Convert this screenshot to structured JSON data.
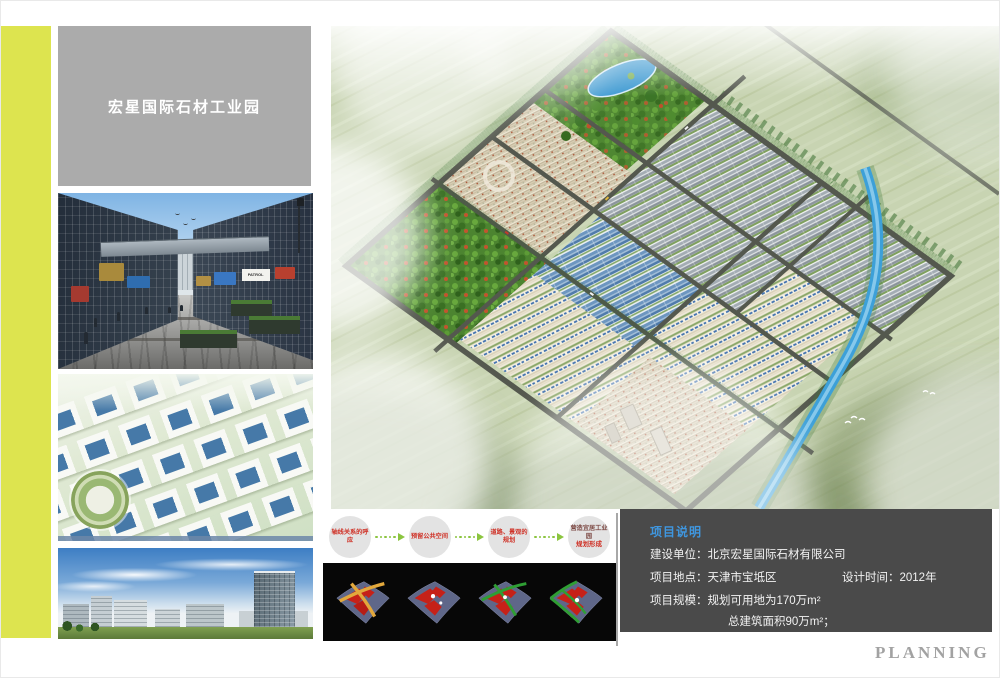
{
  "sidebar": {
    "title": "宏星国际石材工业园"
  },
  "photos": {
    "street_sign": "PATROL"
  },
  "flow_steps": [
    {
      "line1": "轴线关系的呼应",
      "line2": ""
    },
    {
      "line1": "预留公共空间",
      "line2": ""
    },
    {
      "line1": "道路、景观的规划",
      "line2": ""
    },
    {
      "line1": "营造宜居工业园",
      "line2": "规划形成"
    }
  ],
  "project_info": {
    "title": "项目说明",
    "row1_label": "建设单位：",
    "row1_value": "北京宏星国际石材有限公司",
    "row2_label": "项目地点：",
    "row2_value": "天津市宝坻区",
    "row2b_label": "设计时间：",
    "row2b_value": "2012年",
    "row3_label": "项目规模：",
    "row3_value": "规划可用地为170万m²",
    "row4_value": "总建筑面积90万m²；"
  },
  "footer": {
    "planning_label": "PLANNING"
  },
  "colors": {
    "accent_stripe": "#dde44f",
    "title_panel_gray": "#ababab",
    "info_panel_gray": "#4a4a4a",
    "info_title_blue": "#3f97e0",
    "flow_text_red": "#cf3126",
    "arrow_green": "#8bc53f"
  }
}
